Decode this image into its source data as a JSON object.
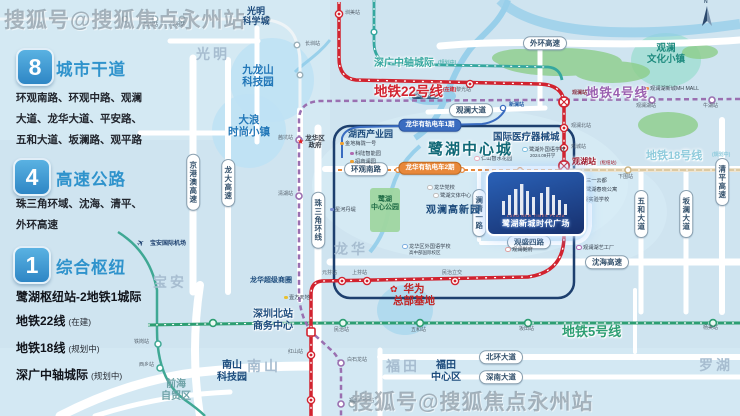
{
  "colors": {
    "bg": "#cfe4f0",
    "road": "#ffffff",
    "river": "#8ecbe9",
    "forest": "#8ccd8a",
    "navy_box": "#1d3f6e",
    "line22": "#d2232f",
    "line4": "#9a6fb0",
    "line5": "#2d9e72",
    "line18": "#dcc9a2",
    "intercity": "#35a79f",
    "intercity_left": "#3fa894",
    "line_light": "#eef4f7",
    "tram1": "#3a6cc0",
    "tram2": "#e8883a",
    "tint": "#d8ecf6",
    "zone_blue": "#bfe2f4",
    "zone_teal": "#a6ded6",
    "park_green": "#9fd6a0",
    "blob_blue": "#a9d7ee"
  },
  "watermarks": {
    "top_left": "搜狐号@搜狐焦点永州站",
    "bottom_right": "搜狐号@搜狐焦点永州站"
  },
  "legend": {
    "arterials": {
      "badge": "8",
      "title": "城市干道",
      "body": "环观南路、环观中路、观澜大道、龙华大道、平安路、五和大道、坂澜路、观平路"
    },
    "expressways": {
      "badge": "4",
      "title": "高速公路",
      "body": "珠三角环域、沈海、清平、外环高速"
    },
    "hub": {
      "badge": "1",
      "title": "综合枢纽",
      "subtitle": "鹭湖枢纽站-2地铁1城际",
      "lines": [
        {
          "name": "地铁22线",
          "tag": "(在建)"
        },
        {
          "name": "地铁18线",
          "tag": "(规划中)"
        },
        {
          "name": "深广中轴城际",
          "tag": "(规划中)"
        }
      ]
    }
  },
  "property": {
    "name": "鹭湖新城时代广场",
    "tagline": "LUHU NEW TIMES PLAZA"
  },
  "compass": "N",
  "labels": [
    {
      "n": "district-guangming",
      "t": "光明",
      "x": 196,
      "y": 46,
      "fs": 14,
      "c": "#a7bdd0",
      "w": 1,
      "ls": 3
    },
    {
      "n": "district-longhua",
      "t": "龙华",
      "x": 334,
      "y": 241,
      "fs": 14,
      "c": "#a7bdd0",
      "w": 1,
      "ls": 3
    },
    {
      "n": "district-baoan",
      "t": "宝安",
      "x": 153,
      "y": 274,
      "fs": 14,
      "c": "#a7bdd0",
      "w": 1,
      "ls": 3
    },
    {
      "n": "district-nanshan",
      "t": "南山",
      "x": 247,
      "y": 358,
      "fs": 14,
      "c": "#a7bdd0",
      "w": 1,
      "ls": 3
    },
    {
      "n": "district-futian",
      "t": "福田",
      "x": 386,
      "y": 358,
      "fs": 14,
      "c": "#a7bdd0",
      "w": 1,
      "ls": 3
    },
    {
      "n": "district-luohu",
      "t": "罗湖",
      "x": 699,
      "y": 357,
      "fs": 14,
      "c": "#a7bdd0",
      "w": 1,
      "ls": 3
    },
    {
      "n": "district-qianhai",
      "t": "前海\n自贸区",
      "x": 176,
      "y": 379,
      "fs": 10,
      "c": "#6fa3a8",
      "w": 1,
      "ctr": 1
    },
    {
      "n": "zone-jiulongshan",
      "t": "九龙山\n科技园",
      "x": 258,
      "y": 64,
      "fs": 10.5,
      "c": "#2277b8",
      "w": 1,
      "ctr": 1
    },
    {
      "n": "zone-dalang",
      "t": "大浪\n时尚小镇",
      "x": 249,
      "y": 114,
      "fs": 10.5,
      "c": "#2277b8",
      "w": 1,
      "ctr": 1
    },
    {
      "n": "zone-guanlan-culture",
      "t": "观澜\n文化小镇",
      "x": 666,
      "y": 44,
      "fs": 9.5,
      "c": "#1d8a7e",
      "w": 1,
      "ctr": 1
    },
    {
      "n": "label-guangming-science-city",
      "t": "光明\n科学城",
      "x": 256,
      "y": 6,
      "fs": 9,
      "c": "#1c4b7c",
      "w": 1,
      "ctr": 1
    },
    {
      "n": "label-huxi-industrial-park",
      "t": "湖西产业园",
      "x": 348,
      "y": 129,
      "fs": 9,
      "c": "#1c4b7c",
      "w": 1
    },
    {
      "n": "label-luhu-central-city",
      "t": "鹭湖中心城",
      "x": 428,
      "y": 141,
      "fs": 15,
      "c": "#0f6876",
      "w": 1,
      "ls": 2,
      "glow": 1
    },
    {
      "n": "label-medical-device-city",
      "t": "国际医疗器械城",
      "x": 493,
      "y": 133,
      "fs": 9.5,
      "c": "#1c4b7c",
      "w": 1,
      "glow": 1
    },
    {
      "n": "label-guanlan-hitech-park",
      "t": "观澜高新园",
      "x": 426,
      "y": 205,
      "fs": 10,
      "c": "#1c4b7c",
      "w": 1,
      "ls": 1
    },
    {
      "n": "label-luhu-central-park",
      "t": "鹭湖\n中心公园",
      "x": 385,
      "y": 196,
      "fs": 7,
      "c": "#1e6b45",
      "w": 1,
      "ctr": 1
    },
    {
      "n": "label-szn-station-cbd",
      "t": "深圳北站\n商务中心",
      "x": 273,
      "y": 309,
      "fs": 10,
      "c": "#1c4b7c",
      "w": 1,
      "ctr": 1,
      "glow": 1
    },
    {
      "n": "label-nanshan-tech-park",
      "t": "南山\n科技园",
      "x": 232,
      "y": 360,
      "fs": 10,
      "c": "#1c4b7c",
      "w": 1,
      "ctr": 1
    },
    {
      "n": "label-futian-cbd",
      "t": "福田\n中心区",
      "x": 446,
      "y": 360,
      "fs": 10,
      "c": "#1c4b7c",
      "w": 1,
      "ctr": 1
    },
    {
      "n": "label-longhua-super-circle",
      "t": "龙华超级商圈",
      "x": 250,
      "y": 277,
      "fs": 7,
      "c": "#1c4b7c",
      "w": 1
    },
    {
      "n": "huawei-flower-icon",
      "t": "✿",
      "x": 390,
      "y": 284,
      "fs": 9,
      "c": "#d42020"
    },
    {
      "n": "label-huawei-hq",
      "t": "华为\n总部基地",
      "x": 414,
      "y": 283,
      "fs": 10.5,
      "c": "#c22525",
      "w": 1,
      "ctr": 1
    },
    {
      "n": "longhua-govt-star-icon",
      "t": "★",
      "x": 297,
      "y": 137,
      "fs": 8,
      "c": "#e02020"
    },
    {
      "n": "label-longhua-govt",
      "t": "龙华区\n政府",
      "x": 315,
      "y": 135,
      "fs": 6.5,
      "c": "#333a44",
      "w": 1,
      "ctr": 1
    },
    {
      "n": "airport-plane-icon",
      "t": "✈",
      "x": 137,
      "y": 238,
      "fs": 9,
      "c": "#1c3f6e",
      "rot": -30
    },
    {
      "n": "label-baoan-airport",
      "t": "宝安国际机场",
      "x": 150,
      "y": 241,
      "fs": 6,
      "c": "#1c3f6e",
      "w": 1
    },
    {
      "n": "label-line22",
      "t": "地铁22号线",
      "x": 374,
      "y": 84,
      "fs": 13.5,
      "c": "#d2232f",
      "w": 1,
      "glow": 1
    },
    {
      "n": "label-line22-tag",
      "t": "(在建)",
      "x": 443,
      "y": 88,
      "fs": 5,
      "c": "#d2232f",
      "w": 1
    },
    {
      "n": "label-line4",
      "t": "地铁4号线",
      "x": 586,
      "y": 86,
      "fs": 12.5,
      "c": "#9a5fb0",
      "w": 1,
      "ls": 1,
      "glow": 1
    },
    {
      "n": "label-line18",
      "t": "地铁18号线",
      "x": 646,
      "y": 150,
      "fs": 11,
      "c": "#8fcbdc",
      "w": 1,
      "glow": 1
    },
    {
      "n": "label-line18-tag",
      "t": "(规划中)",
      "x": 712,
      "y": 153,
      "fs": 5,
      "c": "#8fcbdc",
      "w": 1
    },
    {
      "n": "label-line5",
      "t": "地铁5号线",
      "x": 562,
      "y": 325,
      "fs": 13,
      "c": "#2d9e72",
      "w": 1,
      "glow": 1
    },
    {
      "n": "label-intercity",
      "t": "深广中轴城际",
      "x": 374,
      "y": 58,
      "fs": 10,
      "c": "#35a79f",
      "w": 1,
      "glow": 1
    },
    {
      "n": "label-intercity-tag",
      "t": "(规划中)",
      "x": 438,
      "y": 61,
      "fs": 5,
      "c": "#35a79f"
    },
    {
      "n": "compass-n",
      "t": "N",
      "x": 704,
      "y": 0,
      "fs": 5,
      "c": "#44607a",
      "w": 1
    },
    {
      "n": "station-label",
      "t": "圳美站",
      "x": 345,
      "y": 11
    },
    {
      "n": "station-label",
      "t": "黎光站",
      "x": 456,
      "y": 88
    },
    {
      "n": "station-label",
      "t": "观澜站",
      "x": 572,
      "y": 91,
      "c": "#8a3040",
      "w": 1
    },
    {
      "n": "station-label",
      "t": "观澜北站",
      "x": 571,
      "y": 124
    },
    {
      "n": "station-label",
      "t": "观城站",
      "x": 571,
      "y": 145
    },
    {
      "n": "station-label-guanhu",
      "t": "观湖站",
      "x": 572,
      "y": 157,
      "fs": 8,
      "c": "#a01828",
      "w": 1,
      "glow": 1
    },
    {
      "n": "station-label",
      "t": "(枢纽站)",
      "x": 600,
      "y": 160,
      "fs": 4.5,
      "c": "#a01828"
    },
    {
      "n": "station-label",
      "t": "元芬站",
      "x": 322,
      "y": 271
    },
    {
      "n": "station-label",
      "t": "上芬站",
      "x": 352,
      "y": 271
    },
    {
      "n": "station-label",
      "t": "民治立交",
      "x": 442,
      "y": 271
    },
    {
      "n": "station-label",
      "t": "红山站",
      "x": 288,
      "y": 350
    },
    {
      "n": "station-label",
      "t": "福田口岸站",
      "x": 349,
      "y": 399
    },
    {
      "n": "station-label",
      "t": "白石龙站",
      "x": 347,
      "y": 358
    },
    {
      "n": "station-label",
      "t": "茜坑站",
      "x": 278,
      "y": 136
    },
    {
      "n": "station-label",
      "t": "清湖站",
      "x": 278,
      "y": 192
    },
    {
      "n": "station-label",
      "t": "观澜湖站",
      "x": 636,
      "y": 104
    },
    {
      "n": "station-label",
      "t": "牛湖站",
      "x": 703,
      "y": 104
    },
    {
      "n": "station-label",
      "t": "松岗站",
      "x": 143,
      "y": 23
    },
    {
      "n": "station-label",
      "t": "公明站",
      "x": 170,
      "y": 23
    },
    {
      "n": "station-label",
      "t": "长圳站",
      "x": 305,
      "y": 42
    },
    {
      "n": "station-label",
      "t": "铁岗站",
      "x": 134,
      "y": 340
    },
    {
      "n": "station-label",
      "t": "西乡站",
      "x": 139,
      "y": 363
    },
    {
      "n": "station-label",
      "t": "民治站",
      "x": 334,
      "y": 328
    },
    {
      "n": "station-label",
      "t": "五和站",
      "x": 411,
      "y": 328
    },
    {
      "n": "station-label",
      "t": "坂田站",
      "x": 519,
      "y": 327
    },
    {
      "n": "station-label",
      "t": "杨美站",
      "x": 703,
      "y": 326
    },
    {
      "n": "station-label",
      "t": "下围站",
      "x": 618,
      "y": 175
    },
    {
      "n": "station-label",
      "t": "新澜站",
      "x": 509,
      "y": 103,
      "c": "#2a5fa8",
      "w": 1
    }
  ],
  "pills": [
    {
      "n": "pill-waihuan-expwy",
      "t": "外环高速",
      "x": 545,
      "y": 43
    },
    {
      "n": "pill-guanlan-ave",
      "t": "观澜大道",
      "x": 471,
      "y": 110
    },
    {
      "n": "pill-huanguan-south-rd",
      "t": "环观南路",
      "x": 366,
      "y": 169
    },
    {
      "n": "pill-shenhai-expwy",
      "t": "沈海高速",
      "x": 607,
      "y": 262
    },
    {
      "n": "pill-beihuan-ave",
      "t": "北环大道",
      "x": 501,
      "y": 357
    },
    {
      "n": "pill-shennan-ave",
      "t": "深南大道",
      "x": 501,
      "y": 377
    },
    {
      "n": "pill-guansheng-4th-rd",
      "t": "观盛四路",
      "x": 529,
      "y": 242
    },
    {
      "n": "pill-jinggangao-expwy",
      "t": "京港澳高速",
      "x": 193,
      "y": 182,
      "v": 1
    },
    {
      "n": "pill-longda-expwy",
      "t": "龙大高速",
      "x": 228,
      "y": 183,
      "v": 1
    },
    {
      "n": "pill-prd-ring",
      "t": "珠三角环线",
      "x": 318,
      "y": 220,
      "v": 1
    },
    {
      "n": "pill-lanqing-1st-rd",
      "t": "澜清一路",
      "x": 479,
      "y": 213,
      "v": 1
    },
    {
      "n": "pill-wuhe-ave",
      "t": "五和大道",
      "x": 641,
      "y": 214,
      "v": 1
    },
    {
      "n": "pill-banlan-ave",
      "t": "坂澜大道",
      "x": 686,
      "y": 214,
      "v": 1
    },
    {
      "n": "pill-qingping-expwy",
      "t": "清平高速",
      "x": 722,
      "y": 182,
      "v": 1
    },
    {
      "n": "pill-tram-phase1",
      "t": "龙华有轨电车1期",
      "x": 430,
      "y": 125,
      "kind": "tram1"
    },
    {
      "n": "pill-tram-phase2",
      "t": "龙华有轨电车2期",
      "x": 430,
      "y": 168,
      "kind": "tram2"
    }
  ],
  "pois": [
    {
      "n": "poi",
      "t": "金地梅陇一号",
      "x": 340,
      "y": 140,
      "dot": "#f0a030"
    },
    {
      "n": "poi",
      "t": "科陆智能园",
      "x": 350,
      "y": 150,
      "dot": "#b06ab0"
    },
    {
      "n": "poi",
      "t": "招商澜园",
      "x": 350,
      "y": 158,
      "dot": "#f0a030"
    },
    {
      "n": "poi",
      "t": "星河丹堤",
      "x": 330,
      "y": 206,
      "dot": "#7d8fd0"
    },
    {
      "n": "poi-reservoir",
      "t": "坚塘水库",
      "x": 412,
      "y": 90,
      "chip": 1
    },
    {
      "n": "poi",
      "t": "仁山智水花园",
      "x": 474,
      "y": 155,
      "dot": "#e8b0c0",
      "ring": 1
    },
    {
      "n": "poi",
      "t": "鹭湖外国语学校",
      "x": 522,
      "y": 146,
      "dot": "#80c0e0",
      "ring": 1
    },
    {
      "n": "poi",
      "t": "2024.09开学",
      "x": 530,
      "y": 153,
      "nodot": 1,
      "fs": 4.5
    },
    {
      "n": "poi",
      "t": "三一云都",
      "x": 579,
      "y": 177,
      "dot": "#e0c060",
      "ring": 1
    },
    {
      "n": "poi",
      "t": "鹭湖春晓公寓",
      "x": 579,
      "y": 186,
      "dot": "#e0c060",
      "ring": 1
    },
    {
      "n": "poi",
      "t": "观湖实验学校",
      "x": 573,
      "y": 196,
      "dot": "#80c8d8",
      "sq": 1
    },
    {
      "n": "poi",
      "t": "观澜湖艺工厂",
      "x": 576,
      "y": 244,
      "dot": "#b06ab0",
      "ring": 1
    },
    {
      "n": "poi",
      "t": "观澜湖新城MH MALL",
      "x": 645,
      "y": 85,
      "dot": "#f08030"
    },
    {
      "n": "poi",
      "t": "龙华党校",
      "x": 427,
      "y": 184,
      "dot": "#c0c0c0",
      "ring": 1
    },
    {
      "n": "poi",
      "t": "鹭湖文体中心",
      "x": 433,
      "y": 192,
      "dot": "#c0c0c0",
      "ring": 1
    },
    {
      "n": "poi",
      "t": "龙华区外国语学校",
      "x": 402,
      "y": 243,
      "dot": "#80b0e0",
      "ring": 1
    },
    {
      "n": "poi",
      "t": "高中部国际校区",
      "x": 409,
      "y": 250,
      "nodot": 1,
      "fs": 4.5
    },
    {
      "n": "poi",
      "t": "观澜樾府",
      "x": 505,
      "y": 246,
      "dot": "#e0a0a0",
      "ring": 1
    },
    {
      "n": "poi",
      "t": "壹方天地",
      "x": 284,
      "y": 294,
      "dot": "#e8c030"
    }
  ]
}
